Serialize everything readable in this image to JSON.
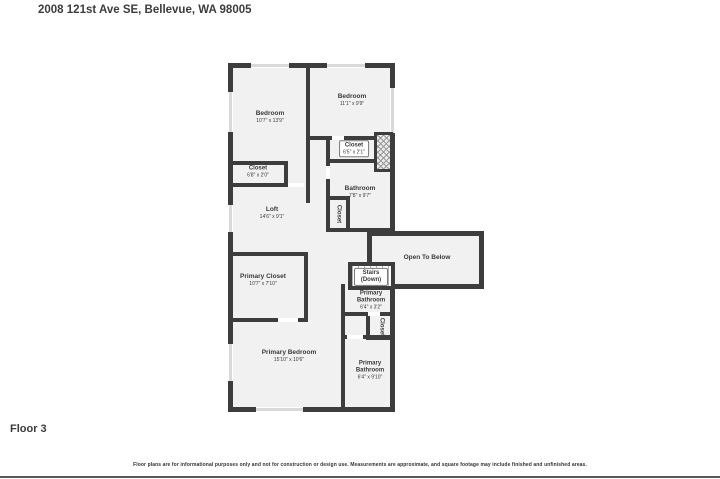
{
  "header": {
    "title": "2008 121st Ave SE, Bellevue, WA 98005"
  },
  "footer": {
    "floor_label": "Floor 3",
    "disclaimer": "Floor plans are for informational purposes only and not for construction or design use. Measurements are approximate, and square footage may include finished and unfinished areas."
  },
  "floorplan": {
    "rooms": {
      "bedroom_left": {
        "name": "Bedroom",
        "dims": "10'7\" x 13'9\""
      },
      "bedroom_right": {
        "name": "Bedroom",
        "dims": "11'1\" x 9'9\""
      },
      "closet_top_right": {
        "name": "Closet",
        "dims": "6'5\" x 2'1\""
      },
      "closet_left": {
        "name": "Closet",
        "dims": "6'8\" x 2'0\""
      },
      "bathroom": {
        "name": "Bathroom",
        "dims": "7'8\" x 9'7\""
      },
      "loft": {
        "name": "Loft",
        "dims": "14'6\" x 9'1\""
      },
      "closet_hall": {
        "name": "Closet"
      },
      "open_to_below": {
        "name": "Open To Below"
      },
      "stairs": {
        "name": "Stairs (Down)"
      },
      "primary_closet": {
        "name": "Primary Closet",
        "dims": "10'7\" x 7'10\""
      },
      "primary_bathroom_upper": {
        "name": "Primary Bathroom",
        "dims": "6'4\" x 3'2\""
      },
      "closet_primary": {
        "name": "Closet"
      },
      "primary_bedroom": {
        "name": "Primary Bedroom",
        "dims": "15'10\" x 10'6\""
      },
      "primary_bathroom_lower": {
        "name": "Primary Bathroom",
        "dims": "6'4\" x 9'10\""
      }
    },
    "colors": {
      "wall": "#3d3d3d",
      "room_fill": "#f1f1f1",
      "window": "#d9d9d9",
      "label_text": "#3a3a3a"
    }
  }
}
